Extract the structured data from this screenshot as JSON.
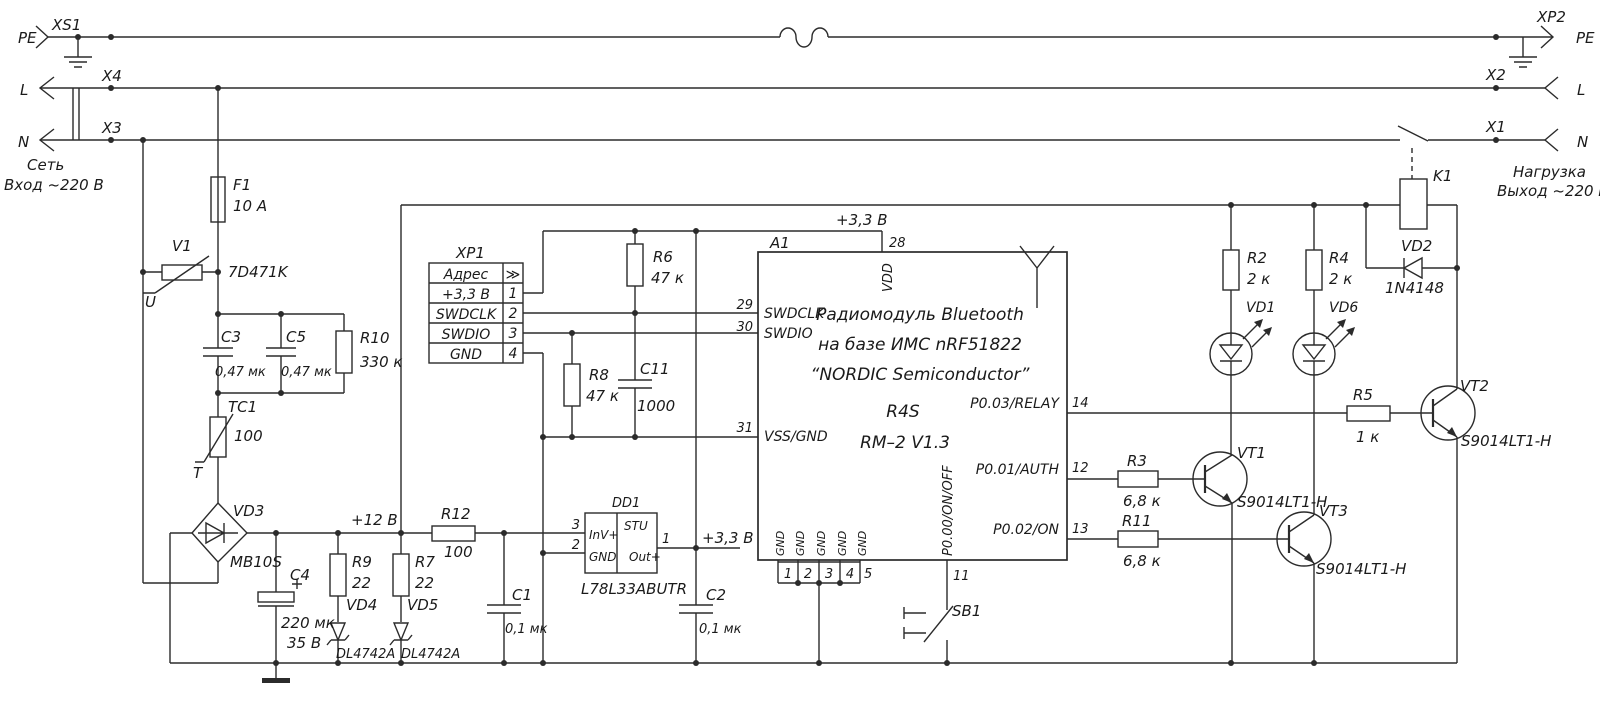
{
  "colors": {
    "wire": "#2b2b2b",
    "text": "#1a1a1a",
    "background": "#ffffff"
  },
  "sch": {
    "input": {
      "plug": "XS1",
      "pe": "PE",
      "x4": "X4",
      "l": "L",
      "x3": "X3",
      "n": "N",
      "caption1": "Сеть",
      "caption2": "Вход  ~220 В"
    },
    "output": {
      "plug": "XP2",
      "pe": "PE",
      "x2": "X2",
      "l": "L",
      "x1": "X1",
      "n": "N",
      "caption1": "Нагрузка",
      "caption2": "Выход  ~220 В"
    },
    "protection": {
      "f1": {
        "ref": "F1",
        "value": "10 A"
      },
      "v1": {
        "ref": "V1",
        "value": "7D471K",
        "electrode": "U"
      },
      "c3": {
        "ref": "C3",
        "value": "0,47 мк"
      },
      "c5": {
        "ref": "C5",
        "value": "0,47 мк"
      },
      "r10": {
        "ref": "R10",
        "value": "330 к"
      },
      "tc1": {
        "ref": "TC1",
        "value": "100",
        "electrode": "T"
      }
    },
    "rectifier": {
      "vd3": {
        "ref": "VD3",
        "value": "MB10S"
      },
      "c4": {
        "ref": "C4",
        "value": "220 мк",
        "voltage": "35 В"
      },
      "rail": "+12 В",
      "r9": {
        "ref": "R9",
        "value": "22"
      },
      "vd4": {
        "ref": "VD4",
        "value": "DL4742A"
      },
      "r7": {
        "ref": "R7",
        "value": "22"
      },
      "vd5": {
        "ref": "VD5",
        "value": "DL4742A"
      }
    },
    "regulator": {
      "r12": {
        "ref": "R12",
        "value": "100"
      },
      "c1": {
        "ref": "C1",
        "value": "0,1 мк"
      },
      "c2": {
        "ref": "C2",
        "value": "0,1 мк"
      },
      "rail": "+3,3 В",
      "dd1": {
        "ref": "DD1",
        "part": "L78L33ABUTR",
        "cell": "STU",
        "pin_in": "InV+",
        "pin_gnd": "GND",
        "pin_out": "Out+",
        "num_in": "3",
        "num_gnd": "2",
        "num_out": "1"
      }
    },
    "swd": {
      "xp1": {
        "ref": "XP1",
        "rows": [
          {
            "label": "Адрес",
            "pin": "≫"
          },
          {
            "label": "+3,3 В",
            "pin": "1"
          },
          {
            "label": "SWDCLK",
            "pin": "2"
          },
          {
            "label": "SWDIO",
            "pin": "3"
          },
          {
            "label": "GND",
            "pin": "4"
          }
        ]
      },
      "r6": {
        "ref": "R6",
        "value": "47 к"
      },
      "r8": {
        "ref": "R8",
        "value": "47 к"
      },
      "c11": {
        "ref": "C11",
        "value": "1000"
      }
    },
    "module": {
      "ref": "A1",
      "rail": "+3,3 В",
      "title_lines": [
        "Радиомодуль Bluetooth",
        "на базе ИМС  nRF51822",
        "“NORDIC Semiconductor”"
      ],
      "model": "R4S",
      "revision": "RM–2   V1.3",
      "pins": {
        "vdd": {
          "name": "VDD",
          "num": "28"
        },
        "swdclk": {
          "name": "SWDCLK",
          "num": "29"
        },
        "swdio": {
          "name": "SWDIO",
          "num": "30"
        },
        "vss": {
          "name": "VSS/GND",
          "num": "31"
        },
        "relay": {
          "name": "P0.03/RELAY",
          "num": "14"
        },
        "auth": {
          "name": "P0.01/AUTH",
          "num": "12"
        },
        "on": {
          "name": "P0.02/ON",
          "num": "13"
        },
        "onoff": {
          "name": "P0.00/ON/OFF",
          "num": "11"
        },
        "gnd_name": "GND",
        "gnd_nums": [
          "1",
          "2",
          "3",
          "4",
          "5"
        ]
      }
    },
    "drivers": {
      "r2": {
        "ref": "R2",
        "value": "2 к"
      },
      "vd1": {
        "ref": "VD1"
      },
      "r4": {
        "ref": "R4",
        "value": "2 к"
      },
      "vd6": {
        "ref": "VD6"
      },
      "r3": {
        "ref": "R3",
        "value": "6,8 к"
      },
      "vt1": {
        "ref": "VT1",
        "value": "S9014LT1-H"
      },
      "r11": {
        "ref": "R11",
        "value": "6,8 к"
      },
      "vt3": {
        "ref": "VT3",
        "value": "S9014LT1-H"
      },
      "r5": {
        "ref": "R5",
        "value": "1 к"
      },
      "vt2": {
        "ref": "VT2",
        "value": "S9014LT1-H"
      }
    },
    "relay": {
      "k1": {
        "ref": "K1"
      },
      "vd2": {
        "ref": "VD2",
        "value": "1N4148"
      }
    },
    "button": {
      "sb1": {
        "ref": "SB1"
      }
    }
  }
}
